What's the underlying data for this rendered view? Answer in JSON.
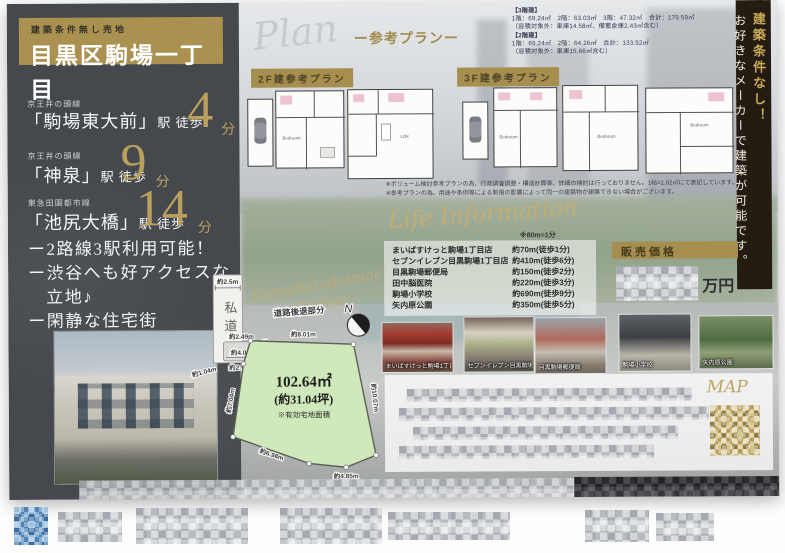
{
  "header": {
    "badge": "建築条件無し売地",
    "title": "目黒区駒場一丁目"
  },
  "stations": [
    {
      "line": "京王井の頭線",
      "name": "「駒場東大前」",
      "walk": "駅 徒歩",
      "min": "4",
      "unit": "分"
    },
    {
      "line": "京王井の頭線",
      "name": "「神泉」",
      "walk": "駅 徒歩",
      "min": "9",
      "unit": "分"
    },
    {
      "line": "東急田園都市線",
      "name": "「池尻大橋」",
      "walk": "駅 徒歩",
      "min": "14",
      "unit": "分"
    }
  ],
  "features": {
    "l1": "ー2路線3駅利用可能！",
    "l2": "ー渋谷へも好アクセスな",
    "l3": "立地♪",
    "l4": "ー閑静な住宅街"
  },
  "plan": {
    "script": "Plan",
    "subtitle": "ー参考プランー",
    "label2f": "2F建参考プラン",
    "label3f": "3F建参考プラン",
    "spec3_title": "【3階建】",
    "spec3_line": "1階：69.24㎡　2階：63.03㎡　3階：47.32㎡　合計：179.59㎡",
    "spec3_note": "（容積対象外：車庫14.58㎡、備蓄倉庫2.43㎡含む）",
    "spec2_title": "【2階建】",
    "spec2_line": "1階：69.24㎡　2階：64.26㎡　合計：133.92㎡",
    "spec2_note": "（容積対象外：車庫15.66㎡含む）",
    "room_bedroom": "Bedroom",
    "room_ldk": "LDK",
    "disc1": "※ボリューム検討参考プランの為、行政調査調整・構造計算等、詳細の検討は行っておりません。1帖=1.62㎡にて表記しています。",
    "disc2": "※参考プランの為、用途や条例等による制限の影響によって同一の建築物が建築できない場合がございます。"
  },
  "banner": {
    "gold": "建築条件なし！",
    "white": "お好きなメーカーで建築が可能です。"
  },
  "life": {
    "script": "Life Information",
    "note": "※80m=1分",
    "items": [
      {
        "name": "まいばすけっと駒場1丁目店",
        "dist": "約70m(徒歩1分)"
      },
      {
        "name": "セブンイレブン目黒駒場1丁目店",
        "dist": "約410m(徒歩6分)"
      },
      {
        "name": "目黒駒場郵便局",
        "dist": "約150m(徒歩2分)"
      },
      {
        "name": "田中脳医院",
        "dist": "約220m(徒歩3分)"
      },
      {
        "name": "駒場小学校",
        "dist": "約690m(徒歩9分)"
      },
      {
        "name": "矢内原公園",
        "dist": "約350m(徒歩5分)"
      }
    ]
  },
  "price": {
    "label": "販売価格",
    "unit": "万円"
  },
  "plot": {
    "bg_script1": "Komabatodaimae",
    "bg_script2": "Station",
    "private_road": "私道",
    "private_road_w": "約2.5m",
    "setback_label": "道路後退部分",
    "north": "N",
    "area": "102.64㎡",
    "tsubo": "(約31.04坪)",
    "note": "※有効宅地面積",
    "d_top": "約8.01m",
    "d_right": "約10.07m",
    "d_bottom_right": "約4.85m",
    "d_bottom_left": "約6.98m",
    "d_left": "約7.04m",
    "s_top": "約2.49m",
    "s_mid": "約4.0m",
    "s_bottom": "約2.90m",
    "s_right": "約1.47m",
    "s_left": "約1.04m"
  },
  "photos": [
    {
      "caption": "まいばすけっと駒場1丁目店"
    },
    {
      "caption": "セブンイレブン目黒駒場1丁目店"
    },
    {
      "caption": "目黒駒場郵便局"
    },
    {
      "caption": "駒場小学校"
    },
    {
      "caption": "矢内原公園"
    }
  ],
  "map": {
    "script": "MAP"
  },
  "colors": {
    "gold": "#ab9150",
    "dark_panel": "#45484d",
    "banner_bg": "#241b13",
    "plot_green": "#cfe9ba"
  }
}
